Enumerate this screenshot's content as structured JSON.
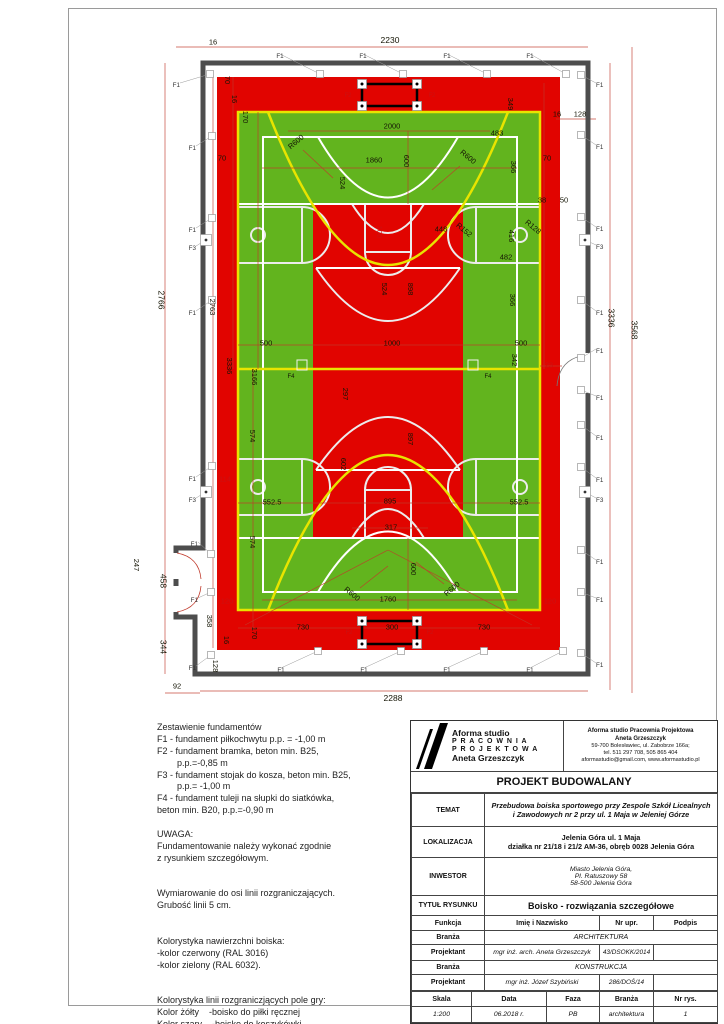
{
  "notes": {
    "lines": [
      "Zestawienie fundamentów",
      "F1 - fundament piłkochwytu p.p. = -1,00 m",
      "F2 - fundament bramka, beton min. B25,",
      "        p.p.=-0,85 m",
      "F3 - fundament stojak do kosza, beton min. B25,",
      "        p.p.= -1,00 m",
      "F4 - fundament tuleji na słupki do siatkówka,",
      "beton min. B20, p.p.=-0,90 m",
      "",
      "UWAGA:",
      "Fundamentowanie należy wykonać zgodnie",
      "z rysunkiem szczegółowym.",
      "",
      "",
      "Wymiarowanie do osi linii rozgraniczających.",
      "Grubość linii 5 cm.",
      "",
      "",
      "Kolorystyka nawierzchni boiska:",
      "-kolor czerwony (RAL 3016)",
      "-kolor zielony (RAL 6032).",
      "",
      "",
      "Kolorystyka linii rozgraniczjących pole gry:",
      "Kolor żółty    -boisko do piłki ręcznej",
      "Kolor szary    -boisko do koszykówki",
      "Kolor biały    -boisko do siatkówki."
    ]
  },
  "title_block": {
    "brand": {
      "line1": "Aforma studio",
      "line2": "P R A C O W N I A",
      "line3": "P R O J E K T O W A",
      "line4": "Aneta Grzeszczyk"
    },
    "contact": [
      "Aforma studio Pracownia Projektowa",
      "Aneta Grzeszczyk",
      "59-700 Bolesławiec, ul. Zabobrze 166a;",
      "tel. 511 297 708, 505 865 404",
      "aformastudio@gmail.com, www.aformastudio.pl"
    ],
    "project_type": "PROJEKT BUDOWALANY",
    "temat_label": "TEMAT",
    "temat": "Przebudowa boiska sportowego przy Zespole Szkół Licealnych\ni Zawodowych nr 2 przy ul. 1 Maja w Jeleniej Górze",
    "lokalizacja_label": "LOKALIZACJA",
    "lokalizacja": "Jelenia Góra ul. 1 Maja\ndziałka nr 21/18 i 21/2 AM-36, obręb 0028 Jelenia Góra",
    "inwestor_label": "INWESTOR",
    "inwestor": "Miasto Jelenia Góra,\nPl. Ratuszowy 58\n58-500 Jelenia Góra",
    "tytul_label": "TYTUŁ RYSUNKU",
    "tytul": "Boisko - rozwiązania szczegółowe",
    "header": [
      "Funkcja",
      "Imię i Nazwisko",
      "Nr upr.",
      "Podpis"
    ],
    "branza1_label": "Branża",
    "branza1": "ARCHITEKTURA",
    "proj1_label": "Projektant",
    "proj1_name": "mgr inż. arch. Aneta Grzeszczyk",
    "proj1_nr": "43/DSOKK/2014",
    "proj1_podpis": "",
    "branza2_label": "Branża",
    "branza2": "KONSTRUKCJA",
    "proj2_label": "Projektant",
    "proj2_name": "mgr inż. Józef Szybiński",
    "proj2_nr": "286/DOŚ/14",
    "proj2_podpis": "",
    "footer_header": [
      "Skala",
      "Data",
      "Faza",
      "Branża",
      "Nr rys."
    ],
    "footer_values": [
      "1:200",
      "06.2018 r.",
      "PB",
      "architektura",
      "1"
    ]
  },
  "drawing": {
    "colors": {
      "field_red": "#e10400",
      "field_green": "#62b41e",
      "handball_yellow": "#e8e400",
      "basketball_gray": "#ececec",
      "volleyball_white": "#ffffff",
      "wall_gray": "#4d4d4d",
      "dim_red": "#c0392b"
    },
    "dims": [
      [
        "2230",
        390,
        40,
        0,
        0,
        8.5
      ],
      [
        "16",
        213,
        42
      ],
      [
        "70",
        227,
        80,
        90
      ],
      [
        "16",
        234,
        99,
        90
      ],
      [
        "170",
        245,
        117,
        90
      ],
      [
        "70",
        222,
        158
      ],
      [
        "70",
        547,
        158
      ],
      [
        "2000",
        392,
        126
      ],
      [
        "349",
        510,
        104,
        90
      ],
      [
        "483",
        497,
        133
      ],
      [
        "16",
        557,
        114
      ],
      [
        "128",
        580,
        114
      ],
      [
        "R600",
        296,
        142,
        -40
      ],
      [
        "R600",
        468,
        157,
        40
      ],
      [
        "1860",
        374,
        160
      ],
      [
        "600",
        406,
        161,
        90
      ],
      [
        "524",
        342,
        183,
        90
      ],
      [
        "366",
        513,
        167,
        90
      ],
      [
        "38",
        542,
        200
      ],
      [
        "50",
        564,
        200
      ],
      [
        "100",
        379,
        232,
        90,
        1
      ],
      [
        "448",
        441,
        229
      ],
      [
        "R152",
        464,
        230,
        40
      ],
      [
        "R128",
        533,
        227,
        40
      ],
      [
        "416",
        511,
        236,
        90
      ],
      [
        "482",
        506,
        257
      ],
      [
        "2766",
        161,
        300,
        90,
        0,
        8.5
      ],
      [
        "2763",
        212,
        307,
        90
      ],
      [
        "524",
        384,
        289,
        90
      ],
      [
        "898",
        410,
        289,
        90
      ],
      [
        "366",
        512,
        300,
        90
      ],
      [
        "500",
        266,
        343
      ],
      [
        "1000",
        392,
        343
      ],
      [
        "500",
        521,
        343
      ],
      [
        "3336",
        229,
        366,
        90
      ],
      [
        "3166",
        254,
        377,
        90
      ],
      [
        "342",
        514,
        360,
        90
      ],
      [
        "23",
        549,
        365,
        0,
        1
      ],
      [
        "F4",
        291,
        377,
        0,
        0,
        6
      ],
      [
        "F4",
        488,
        377,
        0,
        0,
        6
      ],
      [
        "297",
        345,
        394,
        90
      ],
      [
        "574",
        252,
        436,
        90
      ],
      [
        "897",
        410,
        439,
        90
      ],
      [
        "602",
        343,
        464,
        90
      ],
      [
        "114",
        225,
        479,
        0,
        1
      ],
      [
        "552.5",
        272,
        502
      ],
      [
        "895",
        390,
        501
      ],
      [
        "552.5",
        519,
        502
      ],
      [
        "574",
        252,
        542,
        90
      ],
      [
        "317",
        391,
        527
      ],
      [
        "600",
        413,
        569,
        90
      ],
      [
        "R600",
        352,
        594,
        40
      ],
      [
        "R600",
        452,
        589,
        -40
      ],
      [
        "1760",
        388,
        599
      ],
      [
        "120",
        227,
        601,
        0,
        1
      ],
      [
        "120",
        550,
        601,
        0,
        1
      ],
      [
        "247",
        136,
        565,
        90
      ],
      [
        "458",
        163,
        581,
        90,
        0,
        8.5
      ],
      [
        "344",
        163,
        647,
        90,
        0,
        8.5
      ],
      [
        "358",
        209,
        621,
        90
      ],
      [
        "170",
        254,
        633,
        90
      ],
      [
        "16",
        226,
        640,
        90
      ],
      [
        "128",
        215,
        666,
        90
      ],
      [
        "730",
        303,
        627
      ],
      [
        "300",
        392,
        627
      ],
      [
        "730",
        484,
        627
      ],
      [
        "92",
        177,
        686
      ],
      [
        "2288",
        393,
        698,
        0,
        0,
        8.5
      ],
      [
        "3336",
        611,
        318,
        90,
        0,
        8.5
      ],
      [
        "3568",
        634,
        330,
        90,
        0,
        8.5
      ],
      [
        "F2",
        348,
        96,
        0,
        1,
        6
      ],
      [
        "F2",
        432,
        96,
        0,
        1,
        6
      ],
      [
        "F2",
        349,
        633,
        0,
        1,
        6
      ],
      [
        "F2",
        430,
        633,
        0,
        1,
        6
      ]
    ],
    "markers": [
      [
        "F1",
        280,
        56,
        320,
        74,
        "m"
      ],
      [
        "F1",
        363,
        56,
        403,
        74,
        "m"
      ],
      [
        "F1",
        447,
        56,
        487,
        74,
        "m"
      ],
      [
        "F1",
        530,
        56,
        566,
        74,
        "m"
      ],
      [
        "F1",
        180,
        85,
        210,
        74,
        "e"
      ],
      [
        "F1",
        196,
        148,
        212,
        136,
        "e"
      ],
      [
        "F1",
        196,
        230,
        212,
        218,
        "e"
      ],
      [
        "F3",
        196,
        248,
        206,
        240,
        "e"
      ],
      [
        "F1",
        196,
        313,
        212,
        300,
        "e"
      ],
      [
        "F1",
        196,
        479,
        212,
        466,
        "e"
      ],
      [
        "F3",
        196,
        500,
        206,
        492,
        "e"
      ],
      [
        "F1",
        198,
        544,
        211,
        554,
        "e"
      ],
      [
        "F1",
        198,
        600,
        211,
        592,
        "e"
      ],
      [
        "F1",
        196,
        668,
        211,
        655,
        "e"
      ],
      [
        "F1",
        596,
        85,
        581,
        75,
        "s"
      ],
      [
        "F1",
        596,
        147,
        581,
        135,
        "s"
      ],
      [
        "F1",
        596,
        229,
        581,
        217,
        "s"
      ],
      [
        "F3",
        596,
        247,
        585,
        240,
        "s"
      ],
      [
        "F1",
        596,
        313,
        581,
        300,
        "s"
      ],
      [
        "F1",
        596,
        351,
        581,
        358,
        "s"
      ],
      [
        "F1",
        596,
        398,
        581,
        390,
        "s"
      ],
      [
        "F1",
        596,
        438,
        581,
        425,
        "s"
      ],
      [
        "F1",
        596,
        480,
        581,
        467,
        "s"
      ],
      [
        "F3",
        596,
        500,
        585,
        492,
        "s"
      ],
      [
        "F1",
        596,
        562,
        581,
        550,
        "s"
      ],
      [
        "F1",
        596,
        600,
        581,
        592,
        "s"
      ],
      [
        "F1",
        596,
        665,
        581,
        653,
        "s"
      ],
      [
        "F1",
        281,
        670,
        318,
        651,
        "m"
      ],
      [
        "F1",
        364,
        670,
        401,
        651,
        "m"
      ],
      [
        "F1",
        447,
        670,
        484,
        651,
        "m"
      ],
      [
        "F1",
        530,
        670,
        563,
        651,
        "m"
      ]
    ]
  }
}
